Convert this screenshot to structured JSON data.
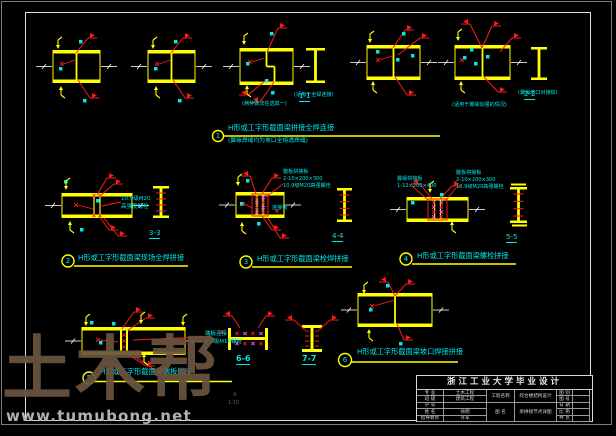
{
  "palette": {
    "line_yellow": "#ffff00",
    "mark_red": "#ff1a1a",
    "note_cyan": "#00e8e8",
    "dim_white": "#ffffff",
    "bolt_magenta": "#ff4fff",
    "frame_gray": "#7c7c7c"
  },
  "details": {
    "d1": {
      "num": "1",
      "title": "H形或工字形截面梁拼接全焊连接",
      "subtitle": "(翼缘焊缝均为坡口全熔透焊缝)"
    },
    "d2": {
      "num": "2",
      "title": "H形或工字形截面梁现场全焊拼接"
    },
    "d3": {
      "num": "3",
      "title": "H形或工字形截面梁栓焊拼接"
    },
    "d4": {
      "num": "4",
      "title": "H形或工字形截面梁螺栓拼接"
    },
    "d5": {
      "num": "5",
      "title": "H形或工字形截面梁端板拼接"
    },
    "d6": {
      "num": "6",
      "title": "H形或工字形截面梁坡口焊接拼接"
    }
  },
  "sections": {
    "s1": "1-1",
    "s2": "2-2",
    "s3": "3-3",
    "s4": "4-4",
    "s5": "5-5",
    "s6": "6-6",
    "s7": "7-7"
  },
  "notes": {
    "top_c": "(两种做法任选其一)",
    "top_s1": "(适用于全焊连接)",
    "top_e": "(适用于翼缘加强的情况)",
    "top_s2": "(翼缘坡口对接焊)",
    "d2_l1": "10.9级M20",
    "d2_l2": "高强度螺栓",
    "d3_l1": "腹板拼接板",
    "d3_l2": "2-10×200×300",
    "d3_l3": "10.9级M20高强螺栓",
    "d3_tag": "连接板",
    "d4l_l1": "翼缘拼接板",
    "d4l_l2": "1-12×200×400",
    "d4r_l1": "腹板拼接板",
    "d4r_l2": "2-10×200×300",
    "d4r_l3": "10.9级M20高强螺栓",
    "d5_l1": "端板连接",
    "d5_l2": "8.8级M16螺栓",
    "stamp_l1": "A",
    "stamp_l2": "1:10"
  },
  "watermark": {
    "brand": "土木帮",
    "url": "www.tumubong.net"
  },
  "title_block": {
    "header": "浙江工业大学毕业设计",
    "left_rows": [
      {
        "label": "专 业",
        "value": "土木工程"
      },
      {
        "label": "班 级",
        "value": "建筑工程"
      },
      {
        "label": "学 号",
        "value": ""
      },
      {
        "label": "姓 名",
        "value": "徐明"
      },
      {
        "label": "指导教师",
        "value": "许军"
      }
    ],
    "project_label": "工程名称",
    "project_value": "综合楼结构设计",
    "drawing_label": "图 名",
    "drawing_value": "梁拼接节点详图",
    "right_rows": [
      {
        "label": "图 别",
        "value": ""
      },
      {
        "label": "图 号",
        "value": ""
      },
      {
        "label": "日 期",
        "value": ""
      },
      {
        "label": "比 例",
        "value": ""
      },
      {
        "label": "共 页",
        "value": ""
      }
    ]
  }
}
